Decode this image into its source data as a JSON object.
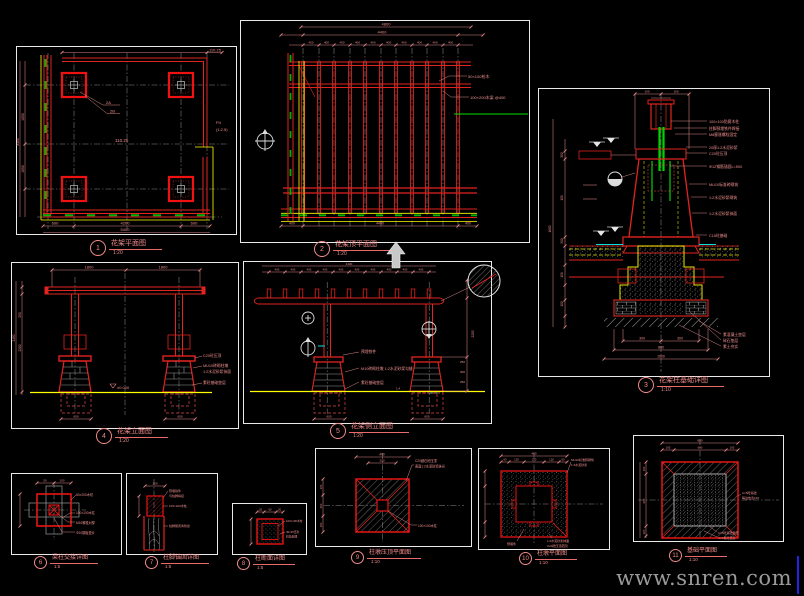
{
  "watermark": "www.snren.com",
  "plan": {
    "num": "1",
    "title": "花架平面图",
    "scale": "1:20",
    "dim_overall": "110.25",
    "dim_center": "110.25",
    "leader1": "2A",
    "leader2": "2B",
    "dims_bottom": [
      "600",
      "4200",
      "600"
    ],
    "dim_bottom_total": "5400",
    "dims_left": [
      "1650",
      "1650"
    ],
    "dim_left_total": "3300",
    "note_r1": "P4",
    "note_r2": "(1:2.5)"
  },
  "roof": {
    "num": "2",
    "title": "花架顶平面图",
    "scale": "1:20",
    "dim_top1": "4800",
    "dim_top2": "4400",
    "rafter_dim": "400",
    "label1": "50×100枋木",
    "label2": "100×200木梁 @400",
    "dims_bottom": [
      "400",
      "4400",
      "400"
    ]
  },
  "section": {
    "num": "3",
    "title": "花架柱基础详图",
    "scale": "1:10",
    "dims_top": [
      "100",
      "100"
    ],
    "labels": [
      "100×100防腐木柱",
      "柱脚预埋铁件焊接",
      "M8膨胀螺栓固定",
      "20厚1:2水泥砂浆",
      "C20砼压顶",
      "Φ12钢筋锚固L=500",
      "MU10标准砖砌筑",
      "1:2水泥砂浆砌筑",
      "1:2水泥砂浆抹面",
      "C15砼基础"
    ],
    "ground_labels": [
      "素混凝土垫层",
      "碎石垫层",
      "素土夯实"
    ],
    "dims_left": [
      "300",
      "150",
      "900",
      "150",
      "100"
    ],
    "dim_left_total": "1600",
    "dims_bottom": [
      "300",
      "300",
      "800",
      "1000"
    ]
  },
  "front": {
    "num": "4",
    "title": "花架立面图",
    "scale": "1:20",
    "dim_top": [
      "1800",
      "1800"
    ],
    "labels": [
      "C20砼压顶",
      "MU10砖砌柱墩",
      "1:2水泥砂浆抹面",
      "素砼基础垫层"
    ],
    "ground": "±0.000",
    "dim_found": "600",
    "dims_left": [
      "250",
      "2200"
    ],
    "dim_left_total": "2450"
  },
  "side": {
    "num": "5",
    "title": "花架侧立面图",
    "scale": "1:20",
    "dim_top_total": "4400",
    "rafter_dim": "400",
    "dim_found": "600",
    "labels": [
      "预埋铁件",
      "M10砖砌柱墩 1:2水泥砂浆勾缝",
      "素砼基础垫层"
    ],
    "dims_right": [
      "250",
      "300",
      "250"
    ],
    "dim_right_total": "2200",
    "ground_note": "1:4"
  },
  "da": {
    "num": "6",
    "title": "梁柱交接详图",
    "scale": "1:5",
    "labels": [
      "50×200木枋",
      "100×100木柱",
      "M10螺栓对穿",
      "Φ10钢板垫片"
    ],
    "dims": [
      "50",
      "100"
    ]
  },
  "db": {
    "num": "7",
    "title": "柱脚锚固详图",
    "scale": "1:5",
    "labels": [
      "预埋铁件",
      "与柱脚焊接",
      "100×100木柱",
      "柱脚刷沥青防腐"
    ],
    "dim": "100"
  },
  "dc": {
    "num": "8",
    "title": "柱断面详图",
    "scale": "1:5",
    "labels": [
      "100×100木柱",
      "45×45压条",
      "斜角处理"
    ],
    "dims": [
      "20",
      "60",
      "20"
    ]
  },
  "dd": {
    "num": "9",
    "title": "柱墩压顶平面图",
    "scale": "1:10",
    "label_top1": "C20细石砼压顶",
    "label_top2": "表面1:2水泥砂浆抹光",
    "label_bottom": "100×100木柱",
    "dim_top": "400",
    "dim_top2": "200",
    "dims_left": [
      "100",
      "200",
      "100"
    ]
  },
  "de": {
    "num": "10",
    "title": "柱墩平面图",
    "scale": "1:10",
    "label_top1": "MU10标准砖砌筑",
    "label_top2": "1:2水泥砂浆",
    "label_b1": "预埋件",
    "label_b2": "1:2水泥砂浆抹面",
    "label_b3": "C20砼压顶范围",
    "dim_top": "480",
    "dims": [
      "60",
      "120",
      "120",
      "120",
      "60"
    ]
  },
  "df": {
    "num": "11",
    "title": "基础平面图",
    "scale": "1:10",
    "label_r1": "C15砼基础",
    "label_r2": "每边放宽100",
    "label_b1": "C15砼基础垫层",
    "label_b2": "C10素砼垫层",
    "dim_top": "800",
    "dims_top": [
      "100",
      "600",
      "100"
    ],
    "dims_left": [
      "100",
      "600",
      "100"
    ]
  }
}
